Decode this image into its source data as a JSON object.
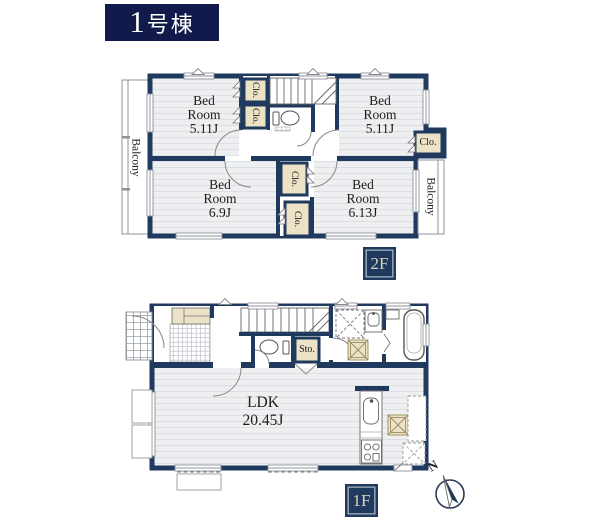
{
  "title": "1号棟",
  "floor2": {
    "badge": "2F",
    "bedroom_tl": {
      "name": "Bed Room",
      "size": "5.11J"
    },
    "bedroom_tr": {
      "name": "Bed Room",
      "size": "5.11J"
    },
    "bedroom_bl": {
      "name": "Bed Room",
      "size": "6.9J"
    },
    "bedroom_br": {
      "name": "Bed Room",
      "size": "6.13J"
    },
    "balcony_left": "Balcony",
    "balcony_right": "Balcony",
    "closet": "Clo."
  },
  "floor1": {
    "badge": "1F",
    "ldk": {
      "name": "LDK",
      "size": "20.45J"
    },
    "storage": "Sto."
  },
  "compass": {
    "north": "N"
  },
  "colors": {
    "wall": "#1f3a5e",
    "title_bg": "#121a4b",
    "closet_fill": "#ece3c7",
    "badge_text": "#d9d3b8",
    "floor_fill": "#edeff1",
    "floor_stripe": "#dcdee2"
  }
}
